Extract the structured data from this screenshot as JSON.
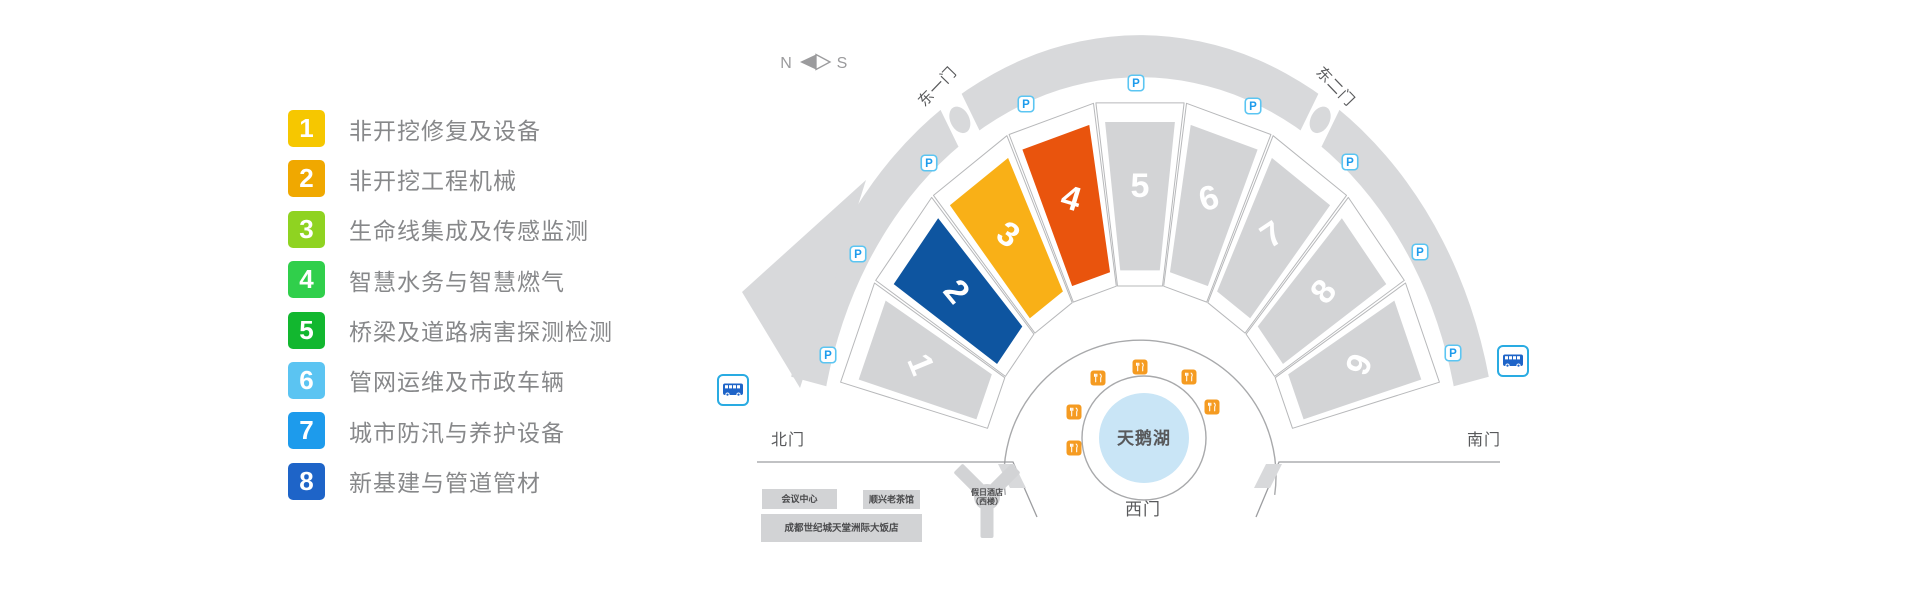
{
  "legend": {
    "items": [
      {
        "num": "1",
        "color": "#F6C700",
        "label": "非开挖修复及设备"
      },
      {
        "num": "2",
        "color": "#F0A800",
        "label": "非开挖工程机械"
      },
      {
        "num": "3",
        "color": "#8FD321",
        "label": "生命线集成及传感监测"
      },
      {
        "num": "4",
        "color": "#30CF4B",
        "label": "智慧水务与智慧燃气"
      },
      {
        "num": "5",
        "color": "#12B72F",
        "label": "桥梁及道路病害探测检测"
      },
      {
        "num": "6",
        "color": "#5BC4F2",
        "label": "管网运维及市政车辆"
      },
      {
        "num": "7",
        "color": "#1D9BEC",
        "label": "城市防汛与养护设备"
      },
      {
        "num": "8",
        "color": "#1E64C8",
        "label": "新基建与管道管材"
      }
    ]
  },
  "map": {
    "compass": {
      "north": "N",
      "south": "S"
    },
    "halls": [
      {
        "num": "1",
        "color": "#D3D4D6",
        "highlighted": false
      },
      {
        "num": "2",
        "color": "#0E55A0",
        "highlighted": true
      },
      {
        "num": "3",
        "color": "#F9B017",
        "highlighted": true
      },
      {
        "num": "4",
        "color": "#E9540D",
        "highlighted": true
      },
      {
        "num": "5",
        "color": "#D3D4D6",
        "highlighted": false
      },
      {
        "num": "6",
        "color": "#D3D4D6",
        "highlighted": false
      },
      {
        "num": "7",
        "color": "#D3D4D6",
        "highlighted": false
      },
      {
        "num": "8",
        "color": "#D3D4D6",
        "highlighted": false
      },
      {
        "num": "9",
        "color": "#D3D4D6",
        "highlighted": false
      }
    ],
    "gates": {
      "east1": "东一门",
      "east2": "东二门",
      "north": "北门",
      "south": "南门",
      "west": "西门"
    },
    "lake": {
      "label": "天鹅湖",
      "color": "#C9E5F6"
    },
    "buildings": [
      {
        "name": "会议中心"
      },
      {
        "name": "顺兴老茶馆"
      },
      {
        "name": "成都世纪城天堂洲际大饭店"
      },
      {
        "name_line1": "假日酒店",
        "name_line2": "（西楼）"
      }
    ],
    "icons": {
      "parking_label": "P",
      "parking_count": 9,
      "bus_count": 2,
      "restaurant_count": 6
    },
    "colors": {
      "band": "#D8D9DB",
      "hall_gray": "#D3D4D6",
      "plot_stroke": "#B7B8BA",
      "ring_stroke": "#A8A9AB",
      "road": "#9C9DA0",
      "building_fill": "#D2D3D5",
      "building_text": "#4A4A4C",
      "label_text": "#58595B",
      "compass": "#9B9B9D",
      "parking_border": "#5BC5F2",
      "parking_text": "#1D9BEC",
      "bus_border": "#29ABE2",
      "bus_glyph": "#1E64C8",
      "food": "#F59B21"
    }
  }
}
